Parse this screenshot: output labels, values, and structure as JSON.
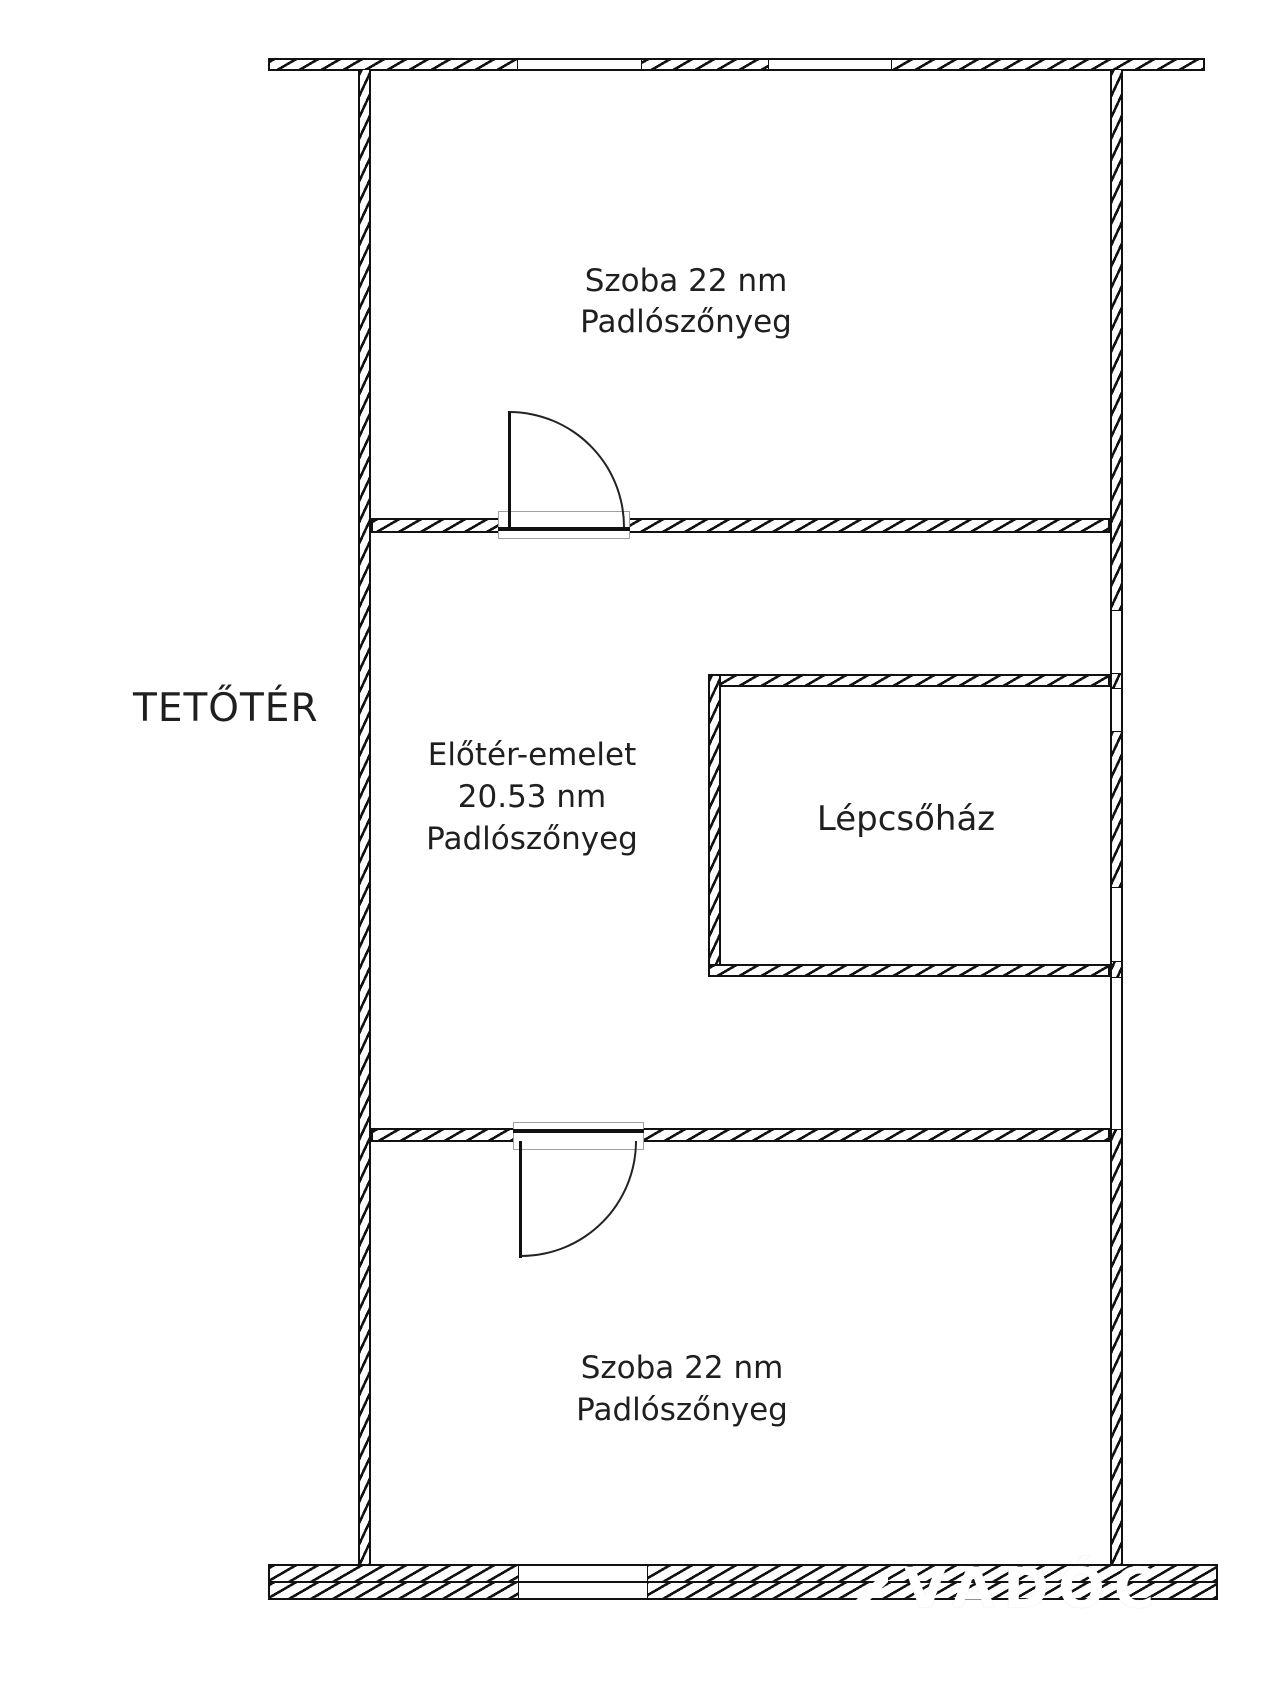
{
  "floor_label": "TETŐTÉR",
  "rooms": {
    "top": {
      "name": "Szoba 22 nm",
      "floor": "Padlószőnyeg"
    },
    "hall": {
      "name": "Előtér-emelet",
      "area": "20.53 nm",
      "floor": "Padlószőnyeg"
    },
    "staircase": {
      "name": "Lépcsőház"
    },
    "bottom": {
      "name": "Szoba 22 nm",
      "floor": "Padlószőnyeg"
    }
  },
  "watermark": {
    "text": "VADÓC"
  },
  "colors": {
    "background": "#ffffff",
    "wall_line": "#111111",
    "label_text": "#1f1f1f",
    "door_frame": "#a0a0a0",
    "watermark_text": "#ffffff"
  }
}
